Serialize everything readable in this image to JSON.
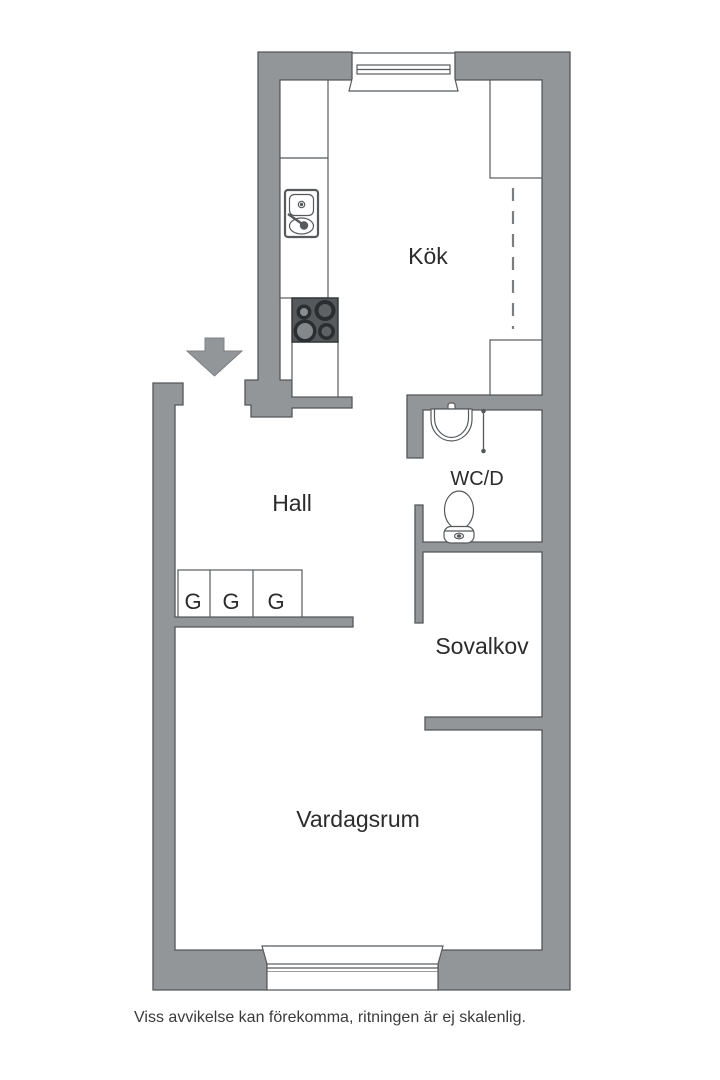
{
  "page": {
    "caption": "Viss avvikelse kan förekomma, ritningen är ej skalenlig."
  },
  "floor_plan": {
    "rooms": {
      "kitchen": "Kök",
      "hall": "Hall",
      "wc": "WC/D",
      "alcove": "Sovalkov",
      "living_room": "Vardagsrum"
    },
    "closets": [
      "G",
      "G",
      "G"
    ],
    "colors": {
      "wall": "#929699",
      "wall_outline": "#53575a",
      "fixture_outline": "#565a5d",
      "stove_body": "#56595b",
      "room_floor": "#ffffff",
      "label_text": "#2b2b2b",
      "caption_text": "#3b3b3b"
    }
  }
}
